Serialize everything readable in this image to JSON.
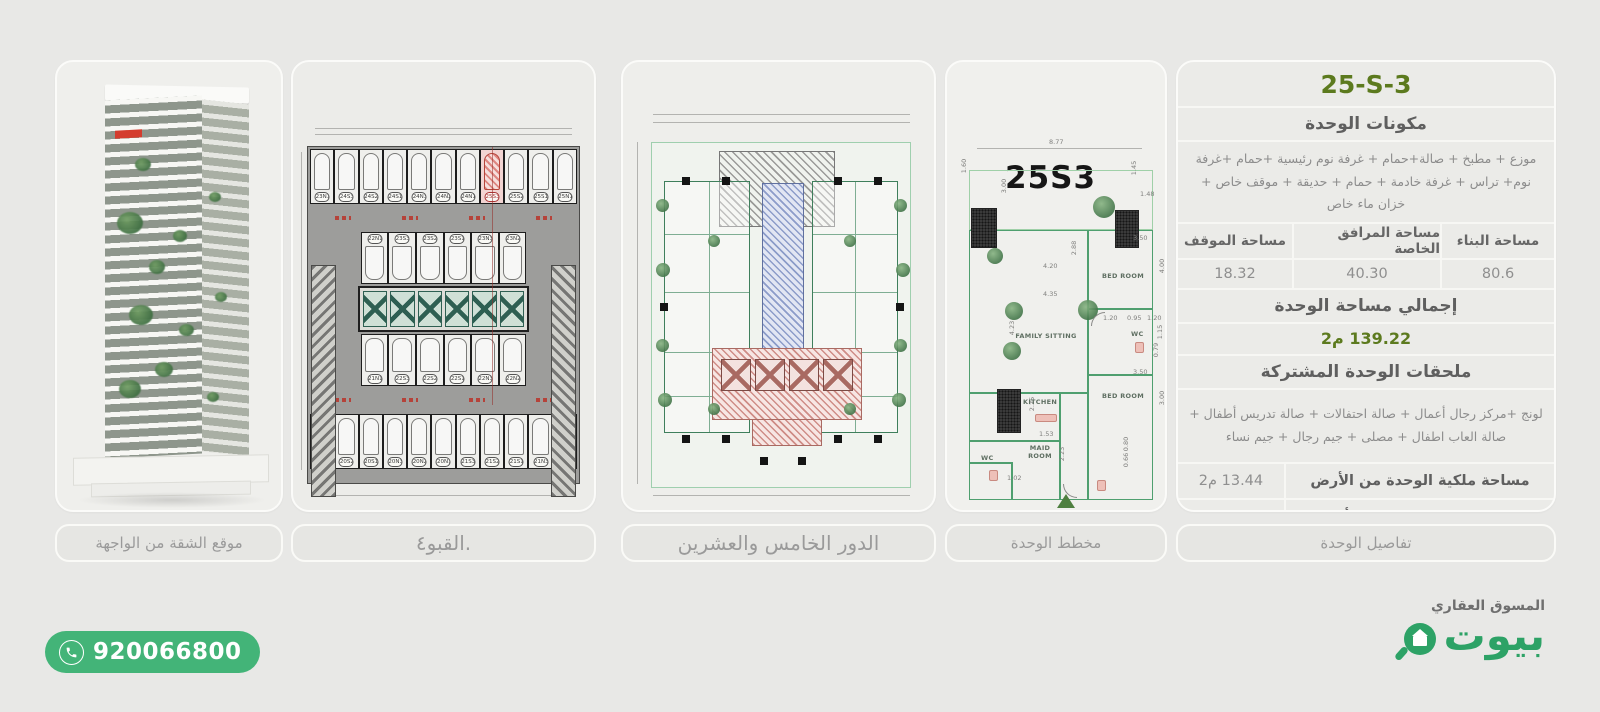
{
  "colors": {
    "page_bg": "#e8e8e6",
    "accent_green": "#5c7a1e",
    "brand_green": "#2da266",
    "phone_green": "#43b478",
    "highlight_red": "#d43c2e"
  },
  "panels": {
    "building": {
      "caption": "موقع الشقة من الواجهة"
    },
    "basement": {
      "caption": "القبو٤.",
      "highlight_stall": "25S3",
      "rows": {
        "top": [
          {
            "label": "23N1"
          },
          {
            "label": "24S3"
          },
          {
            "label": "24S2"
          },
          {
            "label": "24S1"
          },
          {
            "label": "24N3"
          },
          {
            "label": "24N2"
          },
          {
            "label": "24N1"
          },
          {
            "label": "25S3",
            "hl": true
          },
          {
            "label": "25S2"
          },
          {
            "label": "25S1"
          },
          {
            "label": "25N1"
          }
        ],
        "mid_down": [
          "22N1",
          "23S3",
          "23S2",
          "23S1",
          "23N3",
          "23N2"
        ],
        "mid_up": [
          "21N1",
          "22S3",
          "22S2",
          "22S1",
          "22N3",
          "22N2"
        ],
        "bottom": [
          "20S3",
          "20S2",
          "20S1",
          "20N3",
          "20N2",
          "20N1",
          "21S3",
          "21S2",
          "21S1",
          "21N3",
          "21N2"
        ]
      }
    },
    "floor": {
      "caption": "الدور الخامس والعشرين"
    },
    "unit": {
      "caption": "مخطط الوحدة",
      "plan_label": "25S3",
      "rooms": [
        "BED ROOM",
        "WC",
        "BED ROOM",
        "FAMILY SITTING",
        "KITCHEN",
        "MAID ROOM",
        "WC"
      ],
      "dims": [
        "8.77",
        "1.60",
        "3.00",
        "1.45",
        "1.48",
        "3.50",
        "4.00",
        "2.88",
        "4.20",
        "4.35",
        "4.23",
        "1.20",
        "0.95",
        "1.20",
        "1.15",
        "0.79",
        "3.50",
        "3.00",
        "2.25",
        "1.53",
        "2.23",
        "1.02",
        "0.80",
        "0.66"
      ]
    },
    "details": {
      "caption": "تفاصيل الوحدة",
      "title": "25-S-3",
      "components_header": "مكونات الوحدة",
      "components_text": "موزع + مطبخ + صالة+حمام + غرفة نوم رئيسية +حمام +غرفة نوم+ تراس + غرفة خادمة + حمام  + حديقة + موقف خاص + خزان ماء خاص",
      "area_table": {
        "headers": [
          "مساحة البناء",
          "مساحة المرافق الخاصة",
          "مساحة الموقف"
        ],
        "values": [
          "80.6",
          "40.30",
          "18.32"
        ]
      },
      "total_header": "إجمالي مساحة الوحدة",
      "total_value": "139.22 م2",
      "shared_header": "ملحقات الوحدة المشتركة",
      "shared_text": "لونج +مركز رجال أعمال + صالة احتفالات + صالة تدريس أطفال + صالة العاب اطفال + مصلى + جيم رجال + جيم نساء",
      "land_area_label": "مساحة ملكية الوحدة من الأرض",
      "land_area_value": "13.44 م2",
      "land_pct_label": "نسبة ملكية الوحدة من الأرض",
      "land_pct_value": "0.75 %"
    }
  },
  "footer": {
    "phone": "920066800",
    "brand_name": "بيوت",
    "tagline": "المسوق العقاري"
  }
}
